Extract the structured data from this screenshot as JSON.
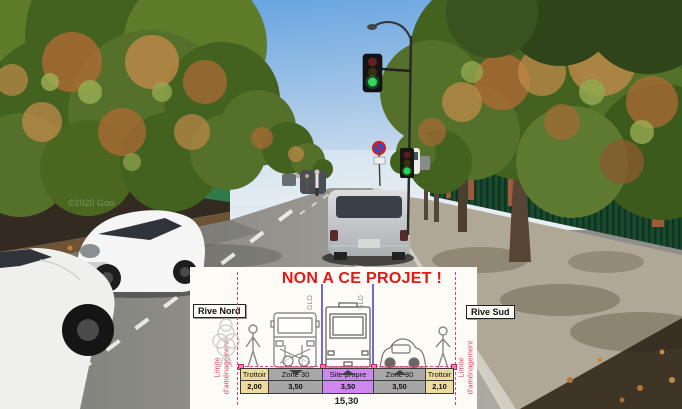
{
  "photo": {
    "road_name_fragment": "evard Ga",
    "copyright_watermark": "©2020 Goo"
  },
  "diagram": {
    "title": "NON A CE PROJET !",
    "bank_left": "Rive Nord",
    "bank_right": "Rive Sud",
    "limit": {
      "line1": "Limite",
      "line2": "d'aménagement"
    },
    "glo": "GLO",
    "total_width_m": "15,30",
    "sections": [
      {
        "label": "Trottoir",
        "width_m": "2,00"
      },
      {
        "label": "Zone 30",
        "width_m": "3,50"
      },
      {
        "label": "Site propre",
        "width_m": "3,50"
      },
      {
        "label": "Zone 30",
        "width_m": "3,50"
      },
      {
        "label": "Trottoir",
        "width_m": "2,10"
      }
    ],
    "colors": {
      "title_red": "#e31818",
      "limit_pink_red": "#d6486b",
      "sidewalk_fill": "#eedc9f",
      "lane_fill": "#a6a6a6",
      "transit_fill": "#cd87ef",
      "glo_line_violet": "#7468d4"
    }
  }
}
